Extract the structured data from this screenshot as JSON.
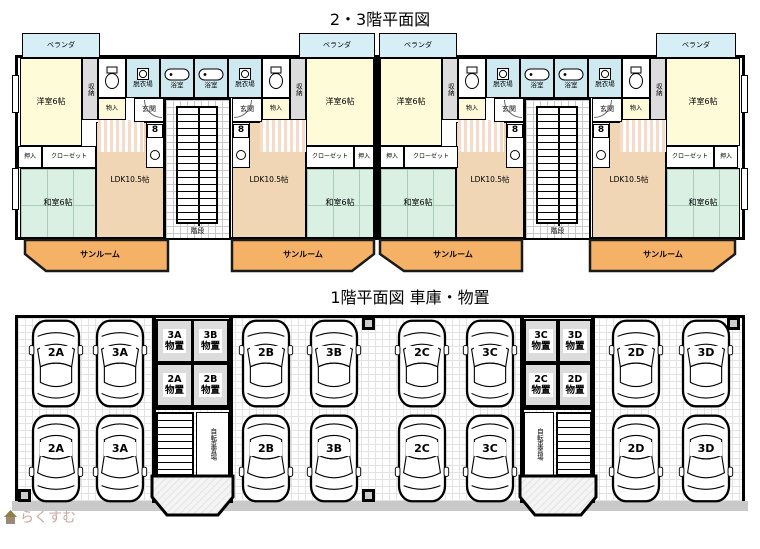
{
  "upper_plan": {
    "title": "2・3階平面図",
    "room_labels": {
      "veranda": "ベランダ",
      "western_room_6": "洋室6帖",
      "closet_shuunou": "収納",
      "storage_monoire": "物入",
      "dressing_room": "脱衣場",
      "bathroom": "浴室",
      "entrance": "玄関",
      "oshiire": "押入",
      "closet": "クローゼット",
      "japanese_room_6": "和室6帖",
      "ldk": "LDK10.5帖",
      "sunroom": "サンルーム",
      "stairs": "階段",
      "stove_symbol": "8"
    }
  },
  "lower_plan": {
    "title": "1階平面図 車庫・物置",
    "bicycle_parking": "自転車置場",
    "cars_top_row": [
      "2A",
      "3A",
      "2B",
      "3B",
      "2C",
      "3C",
      "2D",
      "3D"
    ],
    "cars_bottom_row": [
      "2A",
      "3A",
      "2B",
      "3B",
      "2C",
      "3C",
      "2D",
      "3D"
    ],
    "storage_left": [
      {
        "id": "3A",
        "type": "物置"
      },
      {
        "id": "3B",
        "type": "物置"
      },
      {
        "id": "2A",
        "type": "物置"
      },
      {
        "id": "2B",
        "type": "物置"
      }
    ],
    "storage_right": [
      {
        "id": "3C",
        "type": "物置"
      },
      {
        "id": "3D",
        "type": "物置"
      },
      {
        "id": "2C",
        "type": "物置"
      },
      {
        "id": "2D",
        "type": "物置"
      }
    ]
  },
  "watermark": {
    "text": "らくすむ"
  },
  "colors": {
    "wall": "#000000",
    "veranda": "#d6eef6",
    "western_room": "#fdfbd8",
    "japanese_room": "#d9f0e3",
    "ldk": "#f0d6b4",
    "sunroom": "#f5b266",
    "wet_area": "#cfe9f1",
    "storage_gray": "#dcdcdc",
    "hall_stripe": "#f6dcc8",
    "watermark_text": "#c9a8a0"
  }
}
